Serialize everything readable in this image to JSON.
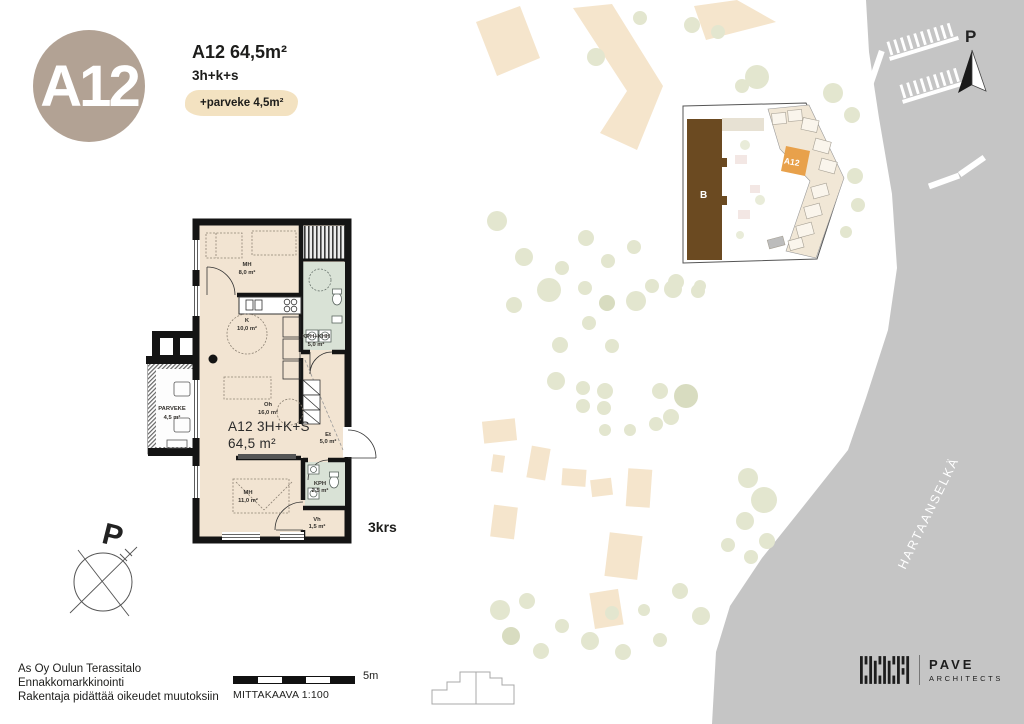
{
  "header": {
    "badge": "A12",
    "title": "A12 64,5m²",
    "subtitle": "3h+k+s",
    "balcony_badge": "+parveke 4,5m²"
  },
  "floorplan": {
    "floor_label": "3krs",
    "unit_line1": "A12 3H+K+S",
    "unit_line2": "64,5 m²",
    "compass_label": "P",
    "rooms": {
      "mh_top": {
        "name": "MH",
        "area": "8,0 m²"
      },
      "kitchen": {
        "name": "K",
        "area": "10,0 m²"
      },
      "kph_khh": {
        "name": "KPH+KHH",
        "area": "5,0 m²"
      },
      "oh": {
        "name": "Oh",
        "area": "16,0 m²"
      },
      "et": {
        "name": "Et",
        "area": "5,0 m²"
      },
      "mh_bottom": {
        "name": "MH",
        "area": "11,0 m²"
      },
      "kph": {
        "name": "KPH",
        "area": "2,5 m²"
      },
      "vh": {
        "name": "Vh",
        "area": "1,5 m²"
      },
      "parveke": {
        "name": "PARVEKE",
        "area": "4,5 m²"
      }
    }
  },
  "siteplan": {
    "north_label": "P",
    "water_label": "HARTAANSELKÄ",
    "locator_building_label": "B",
    "locator_unit_label": "A12"
  },
  "footer": {
    "line1": "As Oy Oulun Terassitalo",
    "line2": "Ennakkomarkkinointi",
    "line3": "Rakentaja pidättää oikeudet muutoksiin",
    "scale_label": "MITTAKAAVA 1:100",
    "scale_distance": "5m"
  },
  "logo": {
    "name": "PAVE",
    "sub": "ARCHITECTS"
  },
  "colors": {
    "badge_circle": "#b2a294",
    "balcony_badge_bg": "#f3e2c1",
    "room_fill": "#f2e4d2",
    "wet_room_fill": "#d9e2d6",
    "wall": "#141414",
    "site_building": "#f5e5cc",
    "tree": "#e3e6cf",
    "water": "#c5c5c5",
    "unit_highlight": "#e8a14b",
    "building_b_brown": "#6b4a21"
  }
}
